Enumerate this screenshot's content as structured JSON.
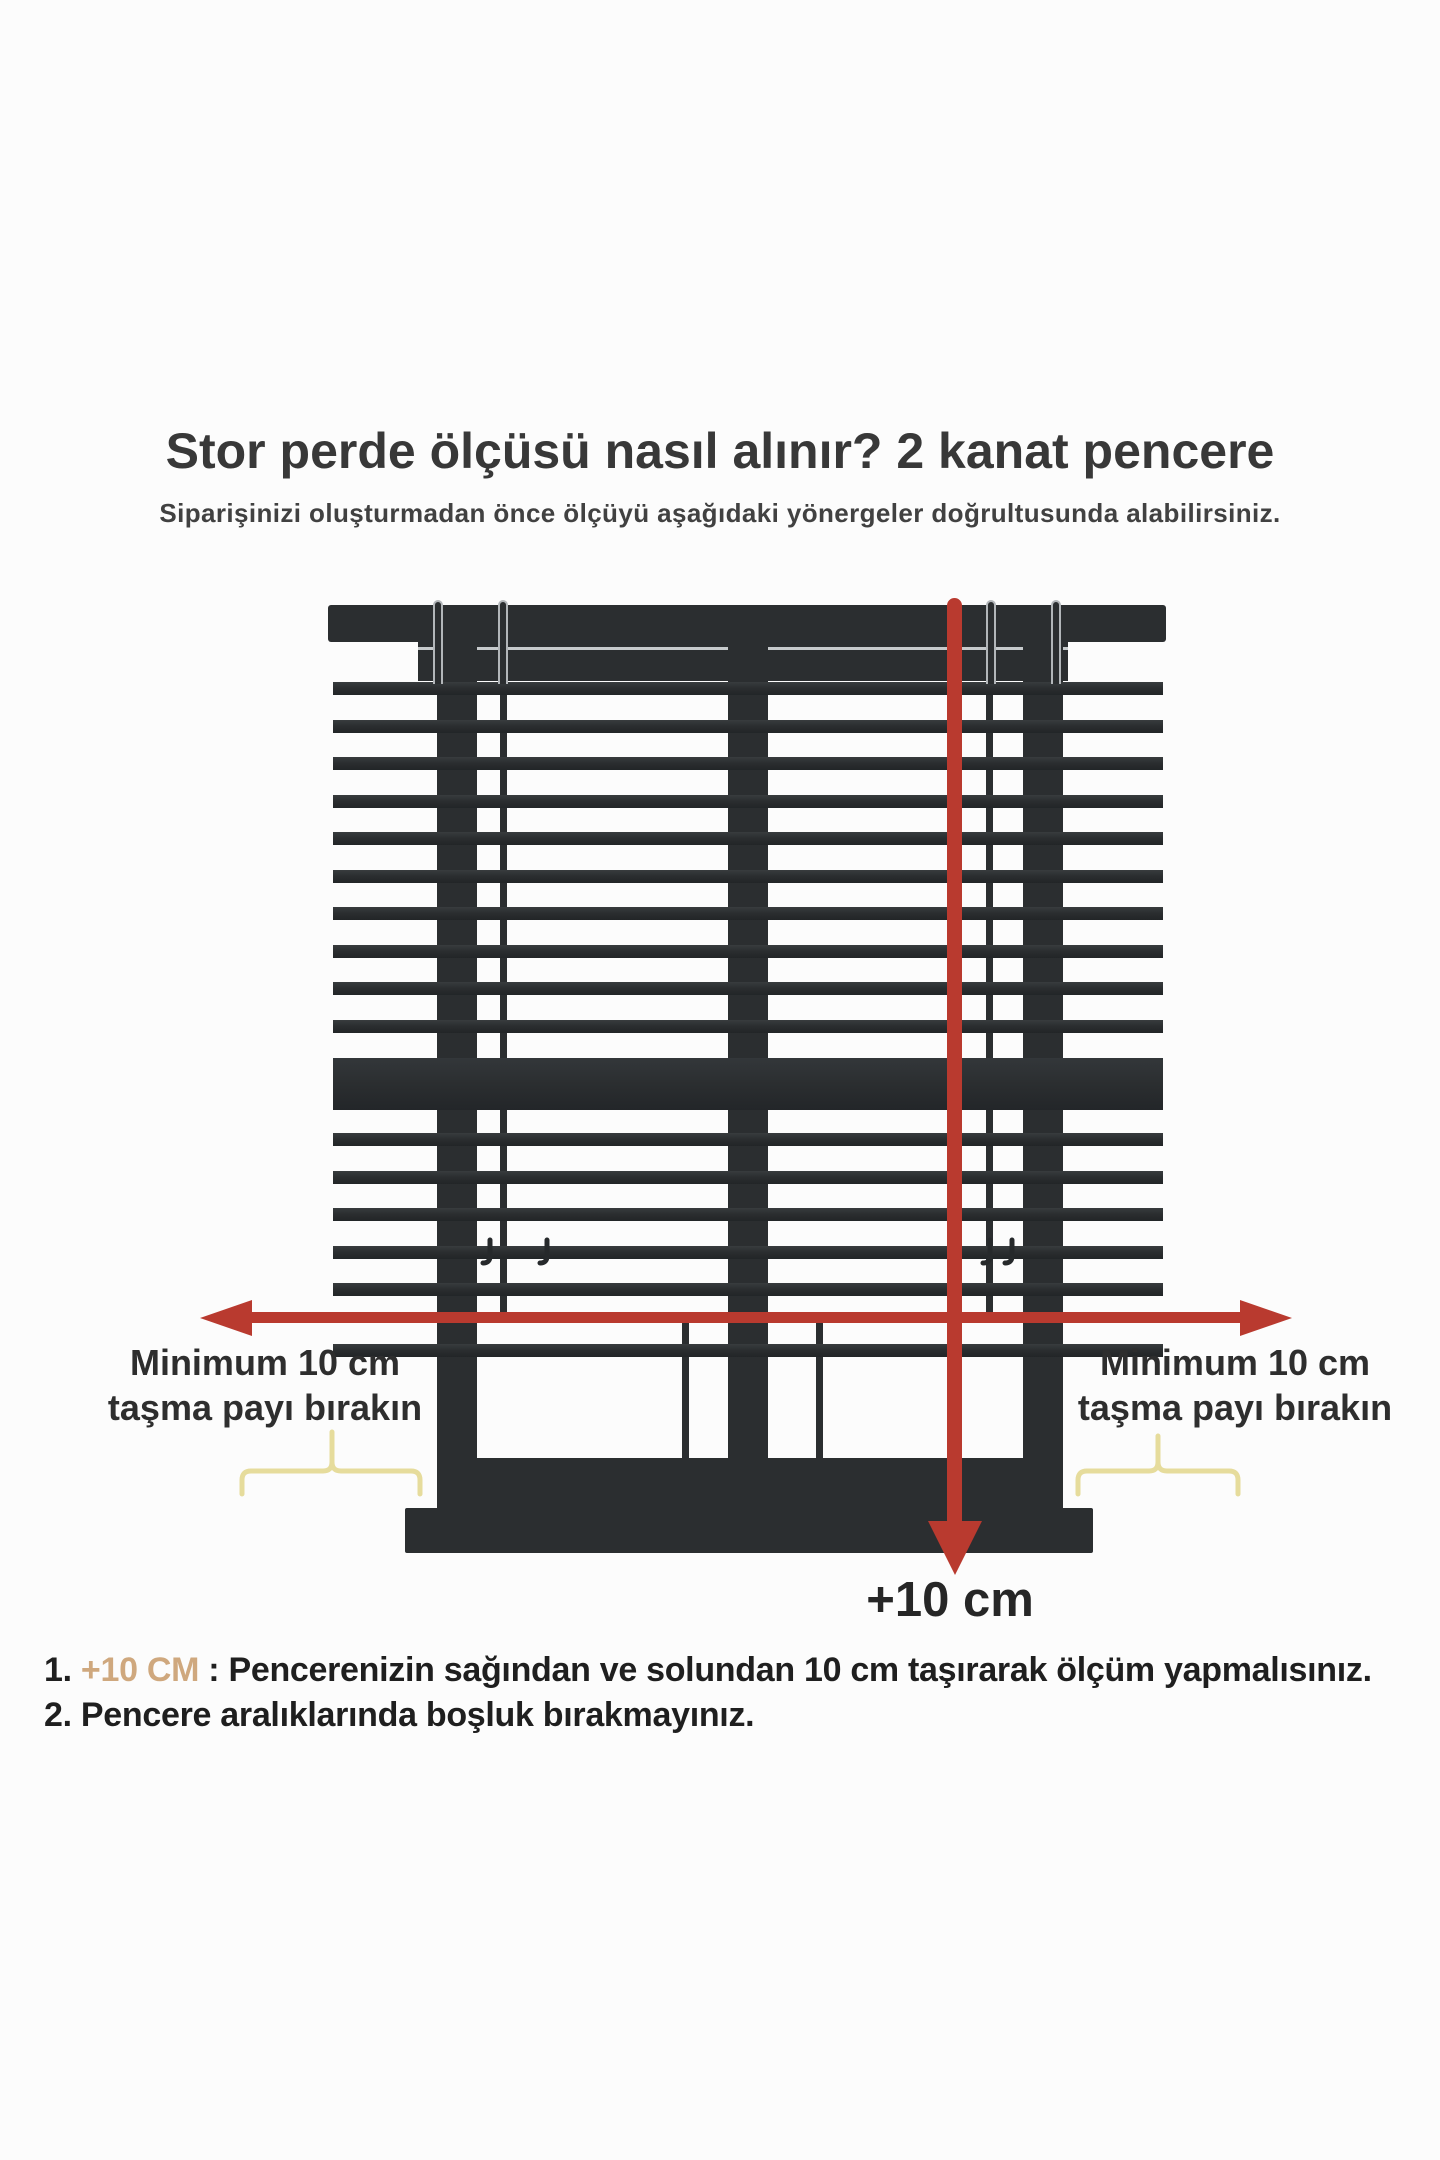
{
  "page": {
    "background_color": "#fcfcfc"
  },
  "header": {
    "title": "Stor perde ölçüsü nasıl alınır? 2 kanat pencere",
    "subtitle": "Siparişinizi oluşturmadan önce ölçüyü aşağıdaki yönergeler doğrultusunda alabilirsiniz."
  },
  "diagram": {
    "left_margin_note": {
      "line1": "Minimum 10 cm",
      "line2": "taşma payı bırakın"
    },
    "right_margin_note": {
      "line1": "Minimum 10 cm",
      "line2": "taşma payı bırakın"
    },
    "vertical_arrow_label": "+10 cm",
    "colors": {
      "frame_dark": "#2b2e30",
      "arrow_red": "#b93a2f",
      "brace_yellow": "#e6dc9c",
      "highlight_tan": "#cfa87e",
      "background": "#fcfcfc"
    }
  },
  "instructions": {
    "item1": {
      "number": "1.",
      "highlight": "+10 CM",
      "separator": " : ",
      "text": "Pencerenizin sağından ve solundan 10 cm taşırarak ölçüm yapmalısınız."
    },
    "item2": {
      "number": "2.",
      "separator": " ",
      "text": "Pencere aralıklarında boşluk bırakmayınız."
    }
  }
}
